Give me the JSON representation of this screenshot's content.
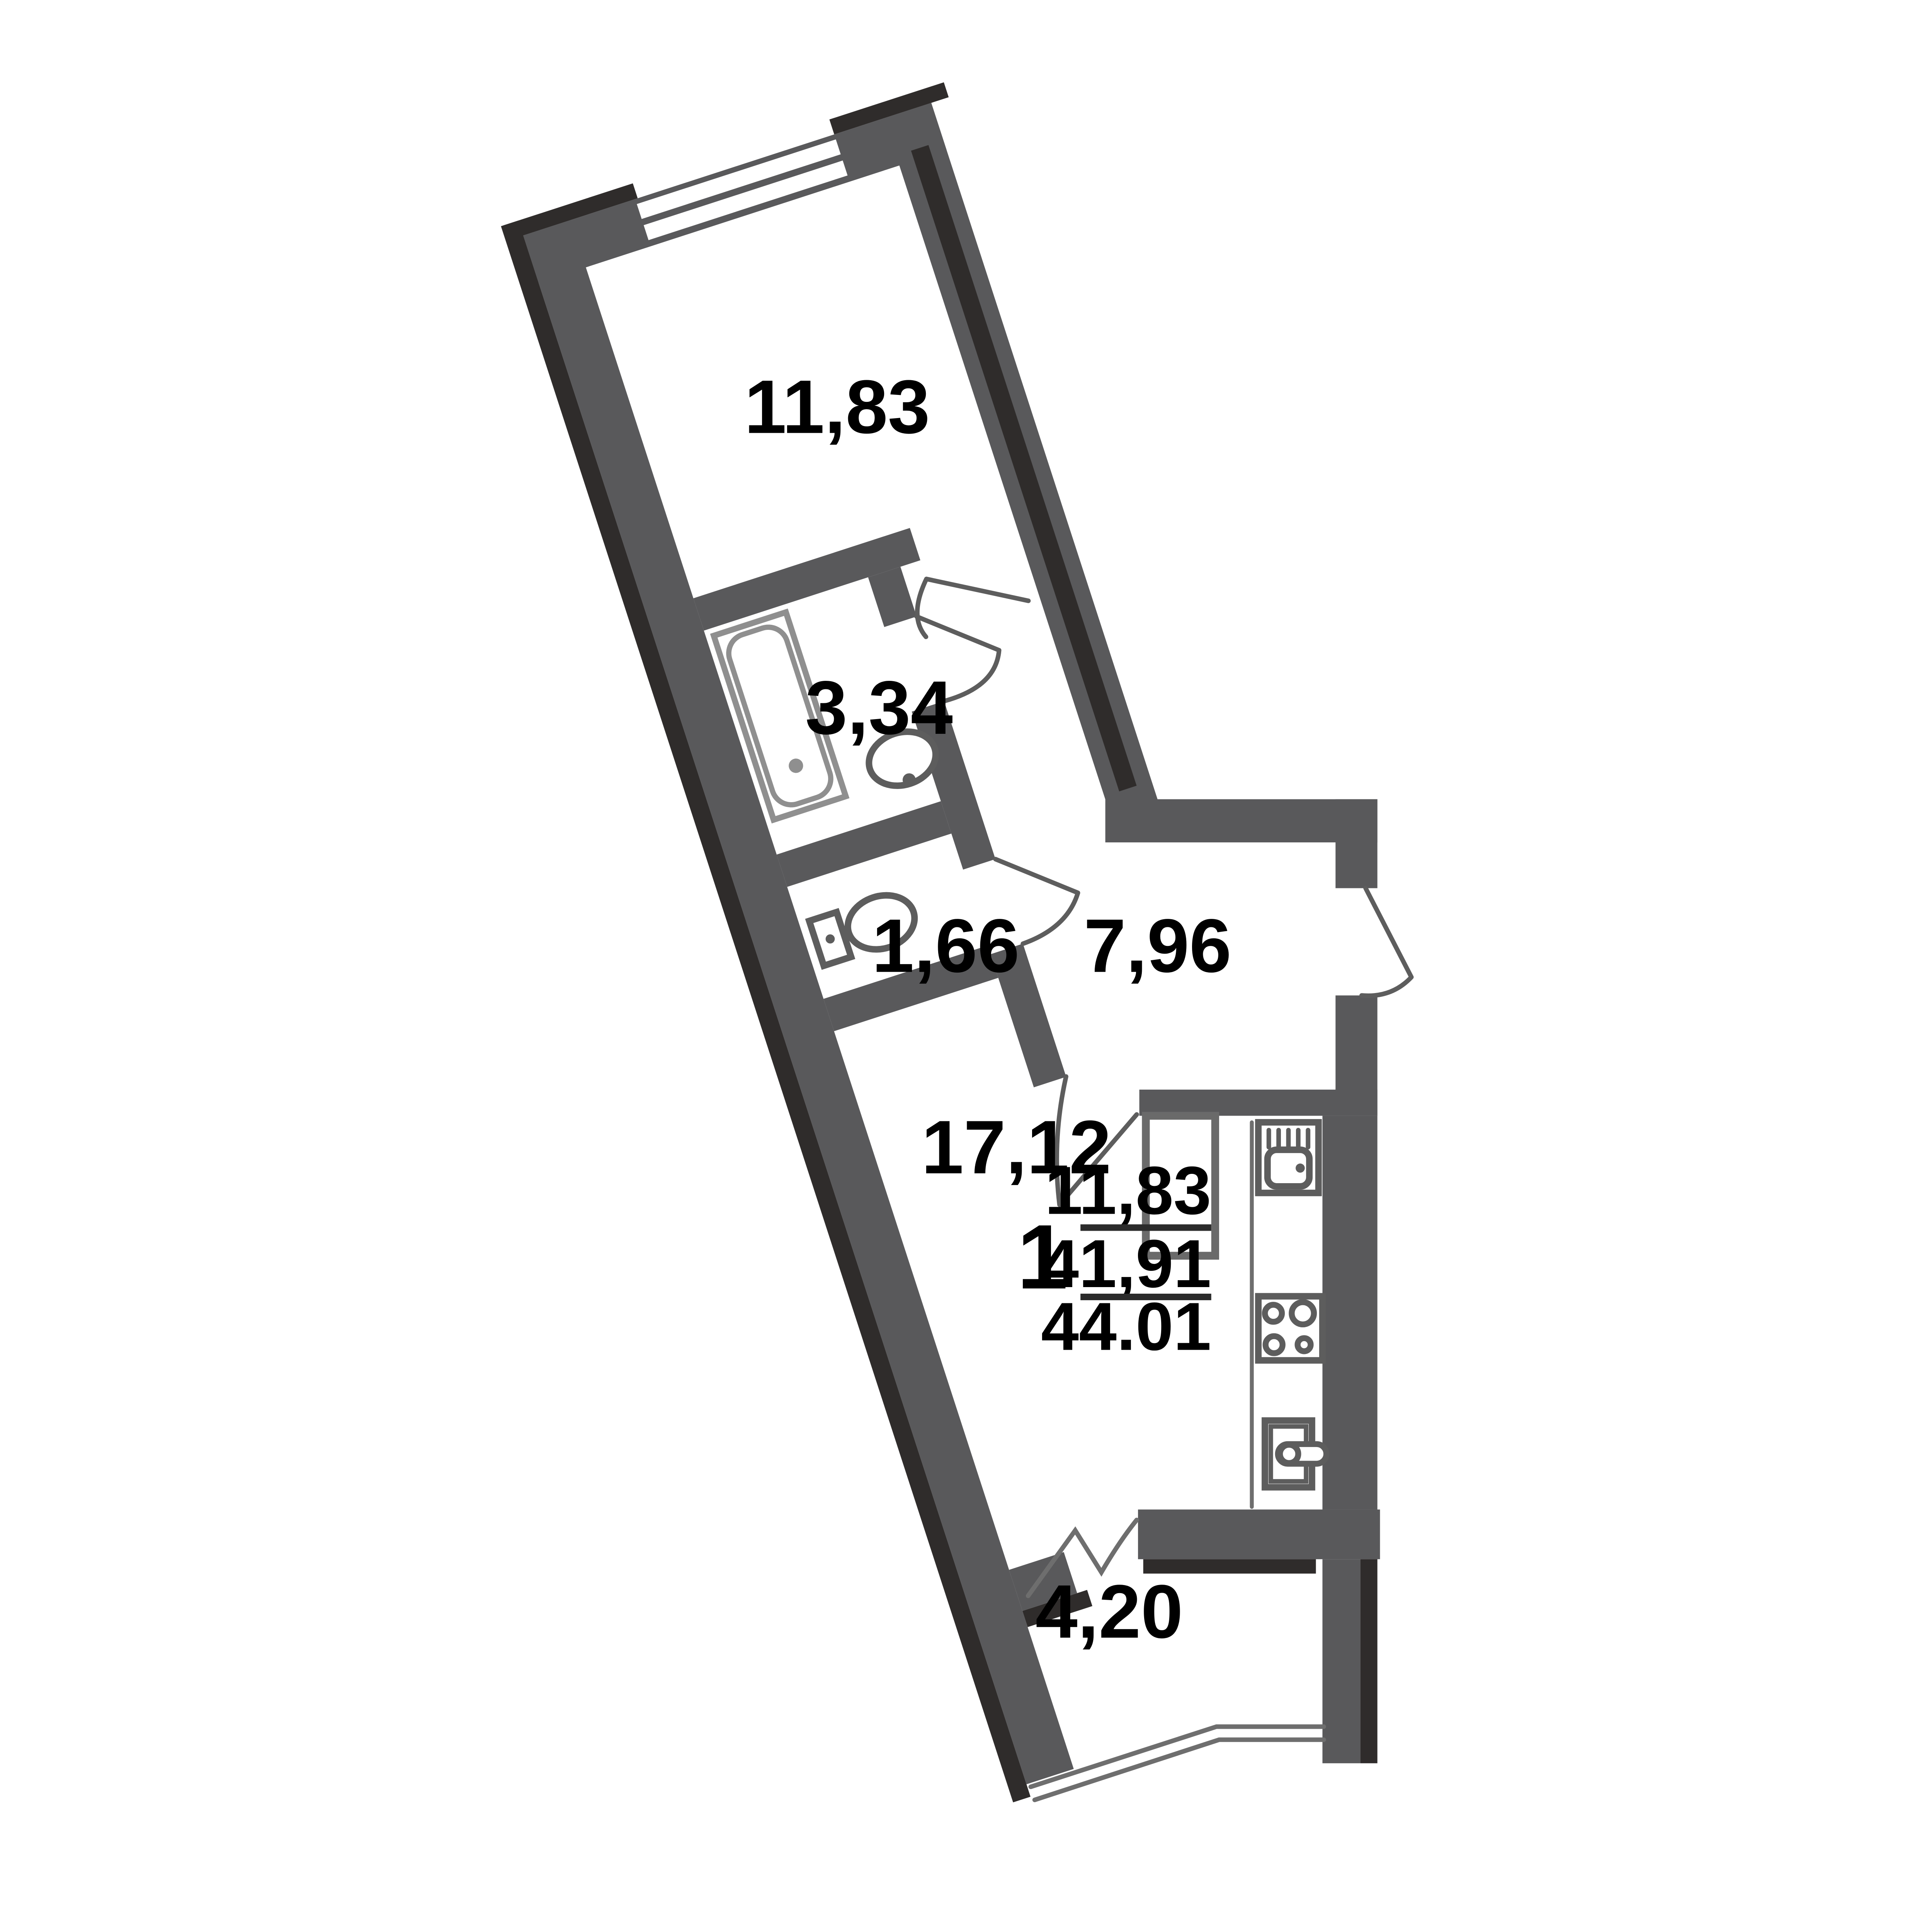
{
  "plan": {
    "title": "1-room apartment floor plan",
    "rotation_deg": -18,
    "rooms": [
      {
        "name": "room",
        "area": "11,83"
      },
      {
        "name": "bathroom",
        "area": "3,34"
      },
      {
        "name": "toilet",
        "area": "1,66"
      },
      {
        "name": "hallway",
        "area": "7,96"
      },
      {
        "name": "living-kitchen",
        "area": "17,12"
      },
      {
        "name": "loggia",
        "area": "4,20"
      }
    ],
    "summary": {
      "rooms_count": "1",
      "living_area": "11,83",
      "apartment_area": "41,91",
      "total_area": "44.01"
    },
    "colors": {
      "wall": "#59595b",
      "wall_shadow": "#2f2c2b",
      "fixture_stroke": "#5d5d5d",
      "tub_stroke": "#8f8f8f",
      "glazing_stroke": "#6e6e6e",
      "text": "#000000",
      "background": "#ffffff"
    },
    "icons": [
      "window-icon",
      "bathtub-icon",
      "washbasin-icon",
      "toilet-icon",
      "door-swing-icon",
      "entrance-door-icon",
      "kitchen-sink-icon",
      "stove-icon",
      "washing-machine-icon",
      "loggia-glazing-icon",
      "vent-shaft-icon"
    ]
  }
}
